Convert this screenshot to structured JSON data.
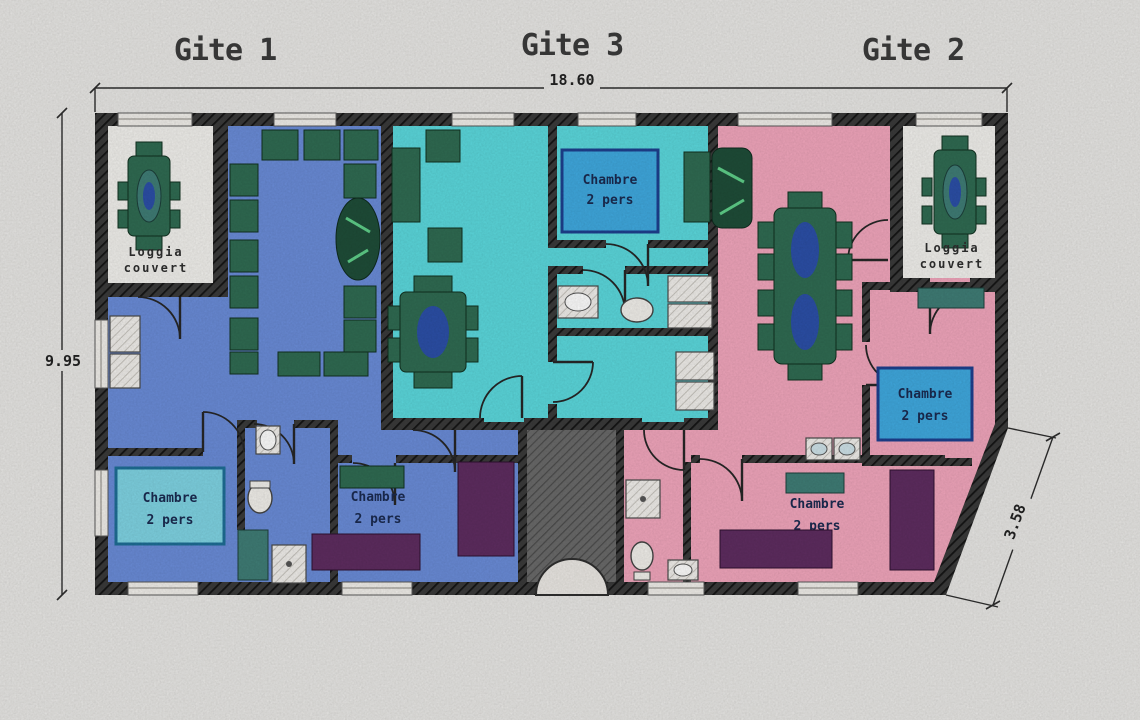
{
  "titles": {
    "gite1": "Gite 1",
    "gite3": "Gite 3",
    "gite2": "Gite 2"
  },
  "dimensions": {
    "total_width_m": "18.60",
    "total_height_m": "9.95",
    "right_side_m": "3.58"
  },
  "rooms": {
    "loggia": {
      "line1": "Loggia",
      "line2": "couvert"
    },
    "chambre": {
      "line1": "Chambre",
      "line2": "2 pers"
    }
  },
  "colors": {
    "paper": "#e9e8e6",
    "gite1_blue": "#6a8cd9",
    "gite3_cyan": "#5bd9de",
    "gite2_pink": "#f2a6bd",
    "bed_blue": "#3fa9e0",
    "bed_cyan": "#7fd4e4",
    "bed_purple": "#5e2c60",
    "furniture_green": "#2f6b52",
    "furniture_teal": "#3f7d76",
    "table_center_blue": "#2b4fa8",
    "wall_dark": "#2c2c2c",
    "hall_gray": "#646464",
    "label_text": "#1a2a50"
  }
}
